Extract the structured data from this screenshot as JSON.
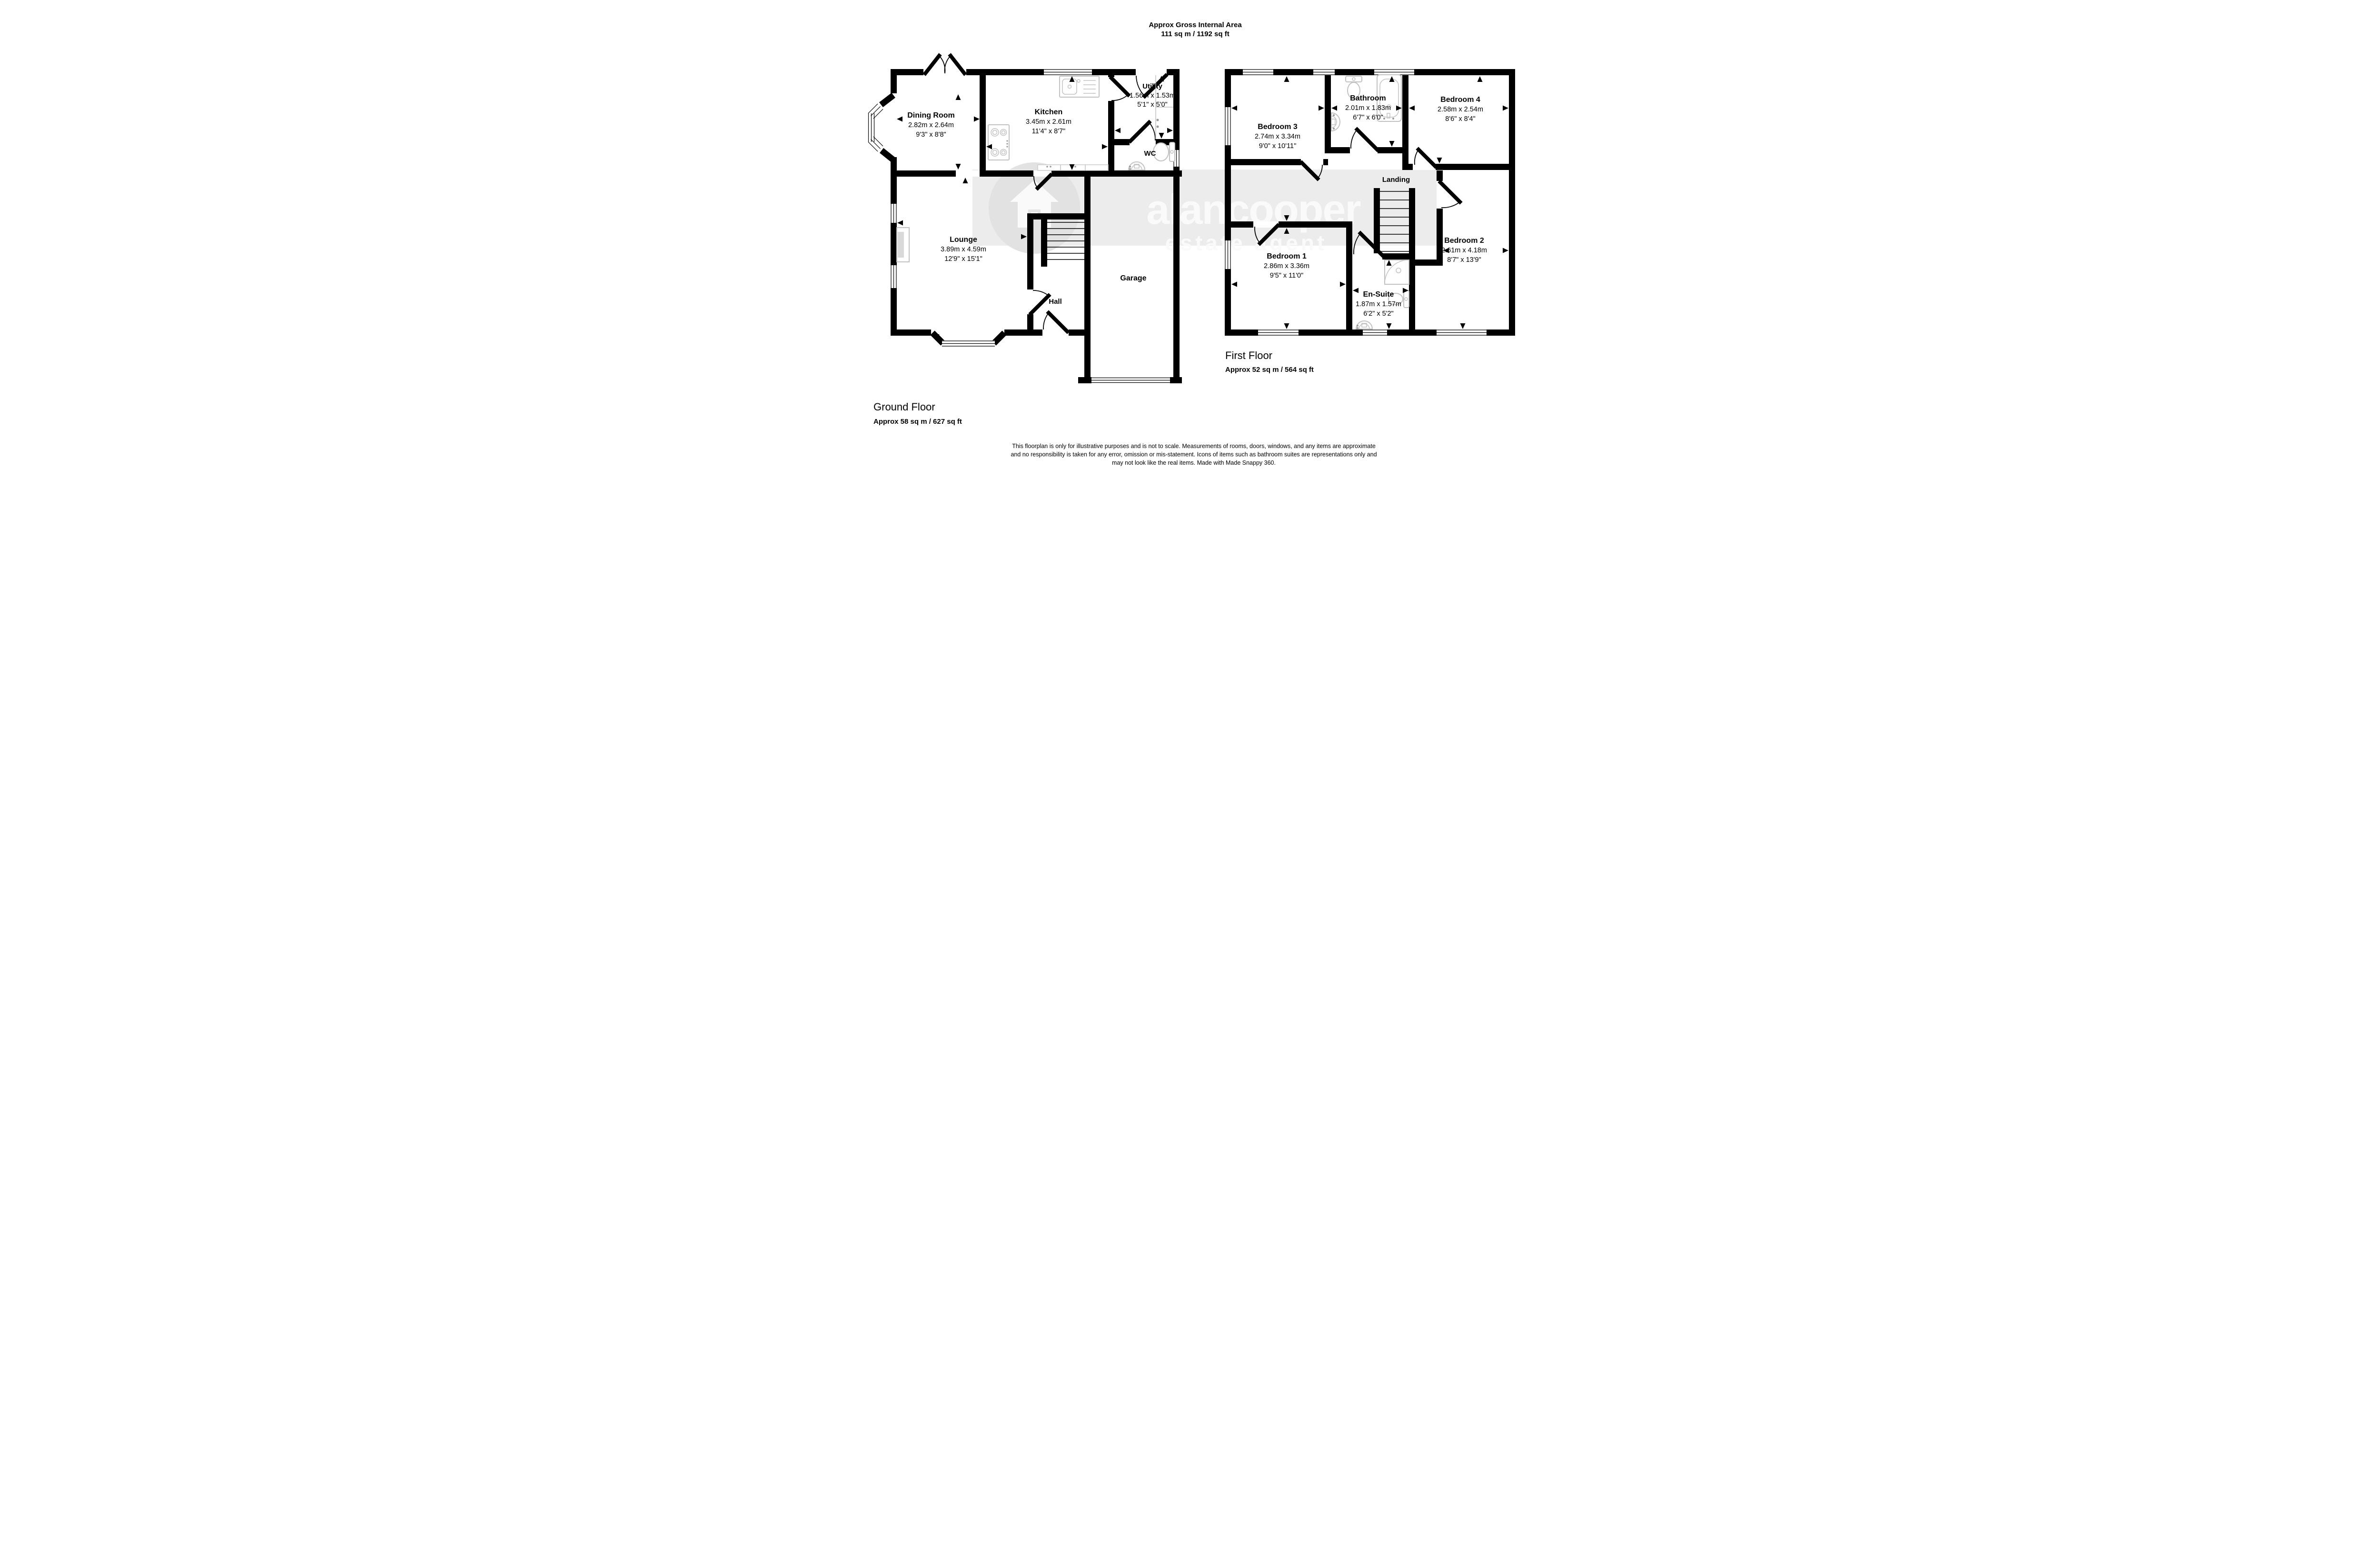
{
  "title": {
    "line1": "Approx Gross Internal Area",
    "line2": "111 sq m / 1192 sq ft"
  },
  "watermark": {
    "brand": "alancooper",
    "tagline": "estate agent"
  },
  "ground_floor": {
    "heading": "Ground Floor",
    "area": "Approx 58 sq m / 627 sq ft",
    "rooms": {
      "dining": {
        "name": "Dining Room",
        "metric": "2.82m x 2.64m",
        "imperial": "9'3\" x 8'8\""
      },
      "kitchen": {
        "name": "Kitchen",
        "metric": "3.45m x 2.61m",
        "imperial": "11'4\" x 8'7\""
      },
      "utility": {
        "name": "Utility",
        "metric": "1.56m x 1.53m",
        "imperial": "5'1\" x 5'0\""
      },
      "wc": {
        "name": "WC"
      },
      "lounge": {
        "name": "Lounge",
        "metric": "3.89m x 4.59m",
        "imperial": "12'9\" x 15'1\""
      },
      "hall": {
        "name": "Hall"
      },
      "garage": {
        "name": "Garage"
      }
    }
  },
  "first_floor": {
    "heading": "First Floor",
    "area": "Approx 52 sq m / 564 sq ft",
    "rooms": {
      "bedroom3": {
        "name": "Bedroom 3",
        "metric": "2.74m x 3.34m",
        "imperial": "9'0\" x 10'11\""
      },
      "bathroom": {
        "name": "Bathroom",
        "metric": "2.01m x 1.83m",
        "imperial": "6'7\" x 6'0\""
      },
      "bedroom4": {
        "name": "Bedroom 4",
        "metric": "2.58m x 2.54m",
        "imperial": "8'6\" x 8'4\""
      },
      "landing": {
        "name": "Landing"
      },
      "bedroom1": {
        "name": "Bedroom 1",
        "metric": "2.86m x 3.36m",
        "imperial": "9'5\" x 11'0\""
      },
      "ensuite": {
        "name": "En-Suite",
        "metric": "1.87m x 1.57m",
        "imperial": "6'2\" x 5'2\""
      },
      "bedroom2": {
        "name": "Bedroom 2",
        "metric": "2.61m x 4.18m",
        "imperial": "8'7\" x 13'9\""
      }
    }
  },
  "disclaimer": {
    "line1": "This floorplan is only for illustrative purposes and is not to scale. Measurements of rooms, doors, windows, and any items are approximate",
    "line2": "and no responsibility is taken for any error, omission or mis-statement. Icons of items such as bathroom suites are representations only and",
    "line3": "may not look like the real items. Made with Made Snappy 360."
  },
  "icons": {
    "kitchen-sink-icon": "double-bowl-sink-outline",
    "hob-icon": "four-burner-hob-outline",
    "toilet-icon": "toilet-outline",
    "basin-icon": "pedestal-basin-outline",
    "bathtub-icon": "bathtub-outline",
    "shower-icon": "corner-shower-outline",
    "fireplace-icon": "fireplace-outline",
    "stairs-icon": "stair-treads",
    "door-icon": "door-swing-arc",
    "window-icon": "triple-line-window",
    "measure-arrow-icon": "solid-black-triangle",
    "house-logo-icon": "house-in-circle"
  },
  "colors": {
    "walls": "#000000",
    "background": "#ffffff",
    "fixtures": "#c2c2c2",
    "counter": "#cccccc",
    "fireplace_fill": "#d9d9d9",
    "watermark_band": "#ececec",
    "watermark_circle": "#e2e2e2",
    "watermark_text": "#fafafa"
  }
}
